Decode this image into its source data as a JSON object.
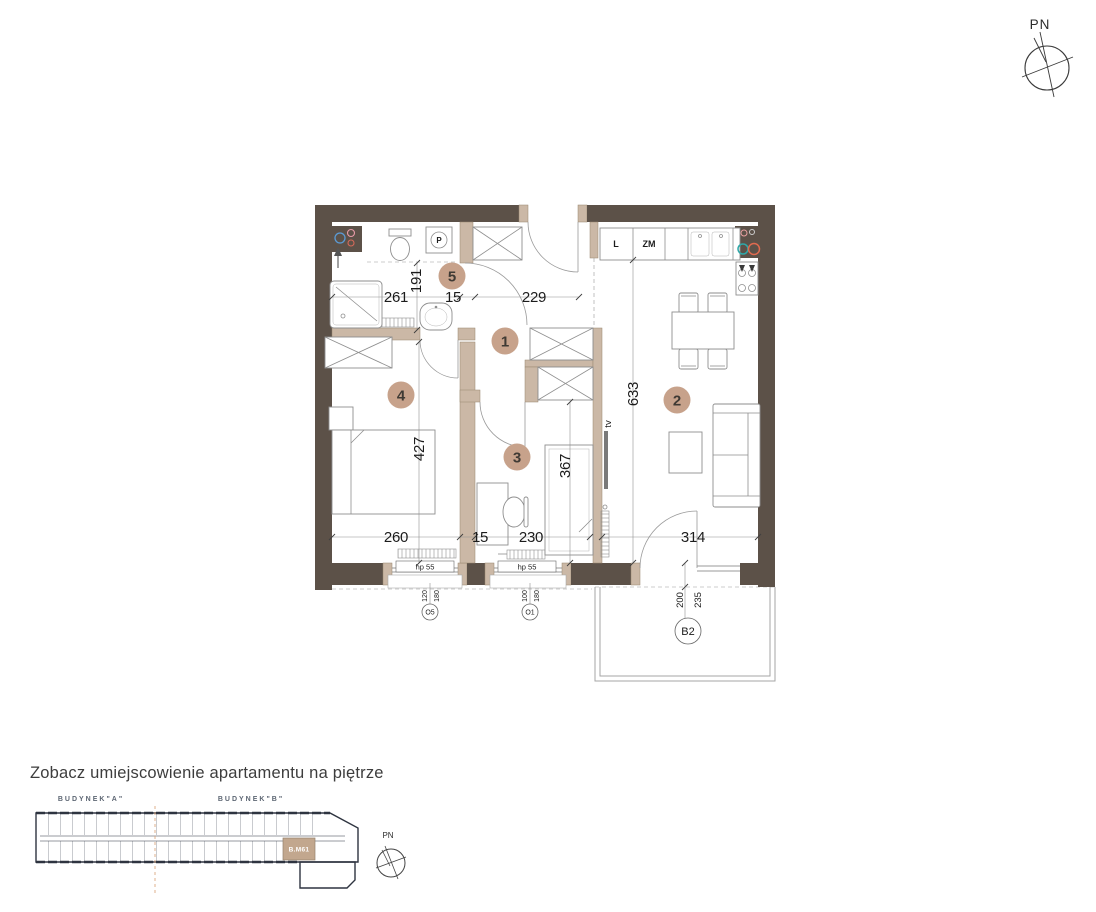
{
  "compass": {
    "label": "PN"
  },
  "plan": {
    "rooms": {
      "r1": "1",
      "r2": "2",
      "r3": "3",
      "r4": "4",
      "r5": "5"
    },
    "kitchen": {
      "fridge": "L",
      "dishwasher": "ZM"
    },
    "labels": {
      "tv": "tv",
      "washer": "P"
    },
    "dims": {
      "bath_width": "261",
      "bath_depth": "191",
      "wall_top": "15",
      "hall_width": "229",
      "apartment_depth": "633",
      "bedroom_depth": "427",
      "room3_depth": "367",
      "bedroom_width": "260",
      "wall_bottom": "15",
      "room3_width": "230",
      "living_width": "314",
      "balcony_depth": "200",
      "balcony_width": "235"
    },
    "windows": {
      "o5": {
        "code": "O5",
        "width": "120",
        "height": "180",
        "sill": "hp 55"
      },
      "o1": {
        "code": "O1",
        "width": "100",
        "height": "180",
        "sill": "hp 55"
      }
    },
    "balcony": {
      "code": "B2"
    }
  },
  "footer": {
    "heading": "Zobacz umiejscowienie apartamentu na piętrze",
    "building_a": "BUDYNEK\"A\"",
    "building_b": "BUDYNEK\"B\"",
    "unit": "B.M61",
    "compass_label": "PN"
  }
}
